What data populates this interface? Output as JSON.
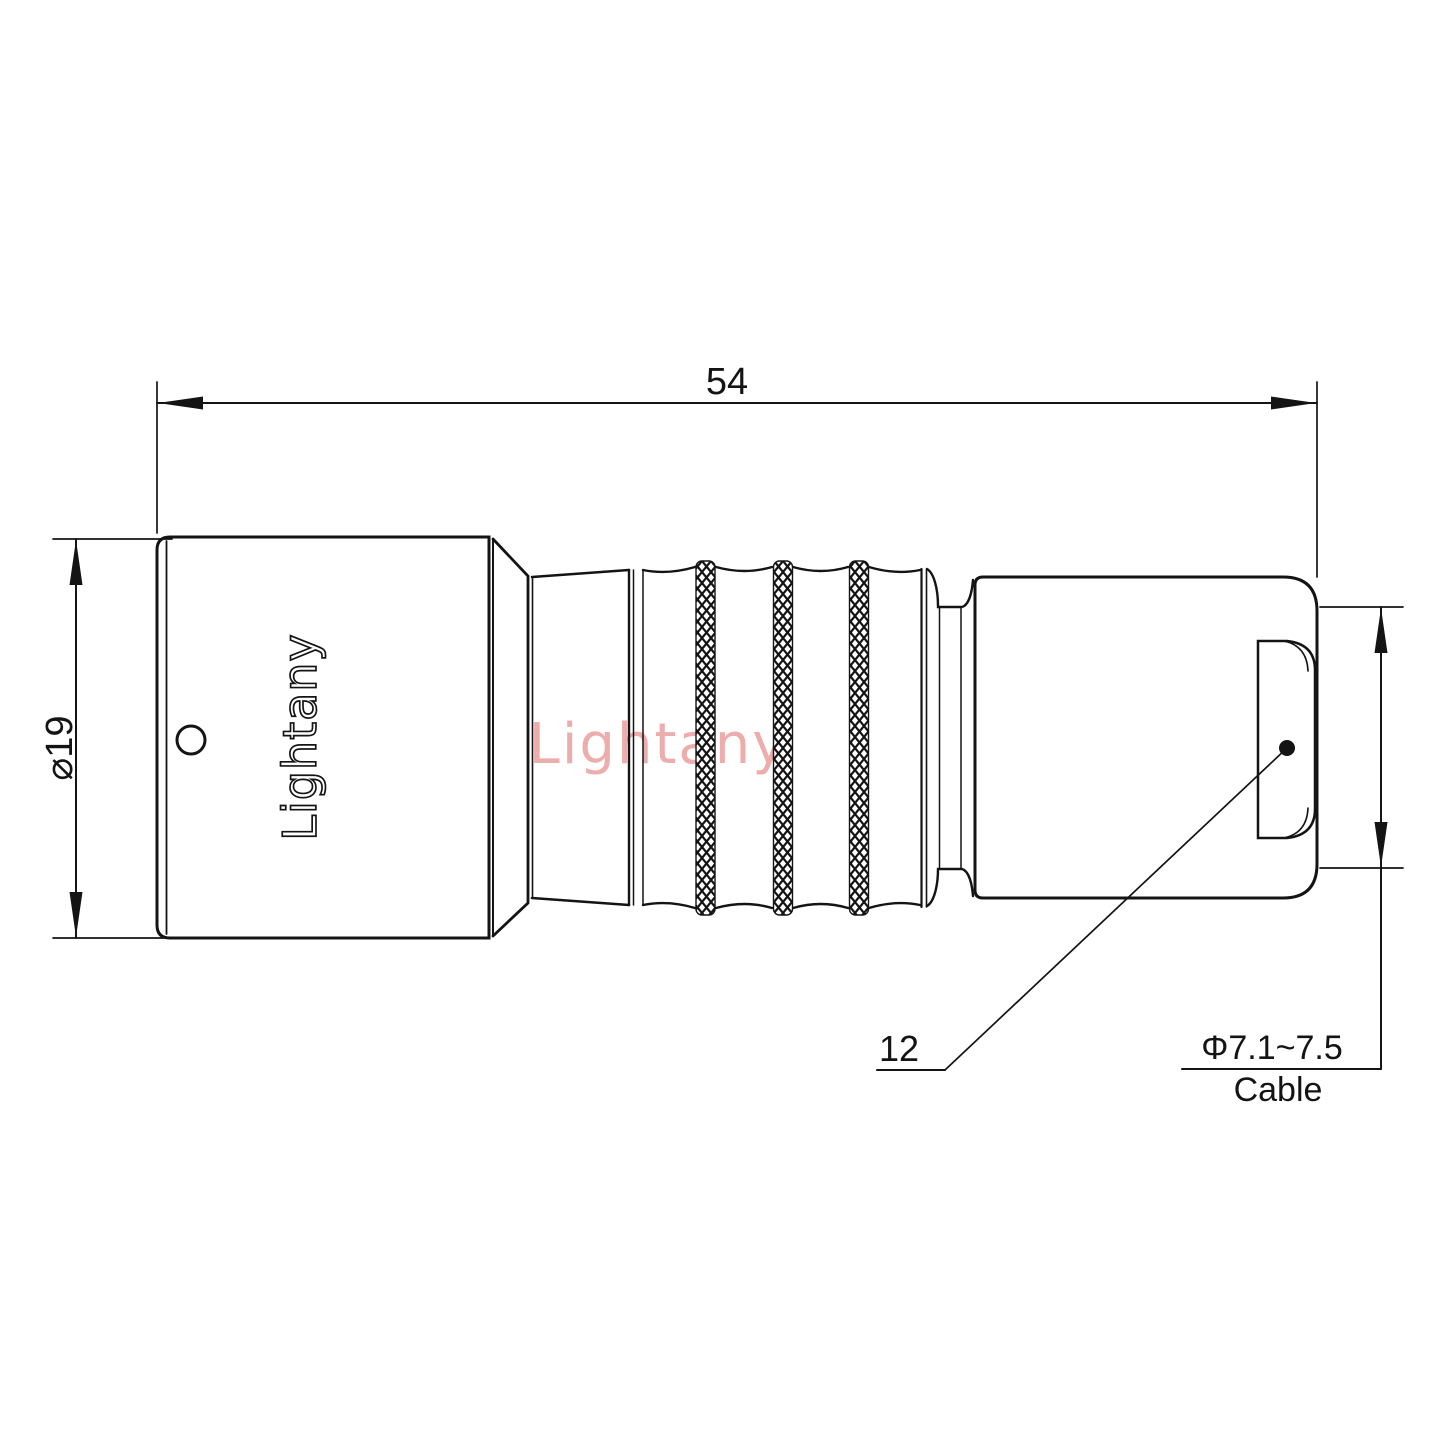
{
  "drawing": {
    "watermark": "Lightany",
    "body_engraving": "Lightany",
    "dimensions": {
      "overall_length": "54",
      "body_diameter": "⌀19",
      "bushing_ref": "12",
      "cable_diameter": "Φ7.1~7.5",
      "cable_label": "Cable"
    },
    "colors": {
      "line": "#141414",
      "watermark": "#edadad",
      "background": "#ffffff"
    }
  }
}
